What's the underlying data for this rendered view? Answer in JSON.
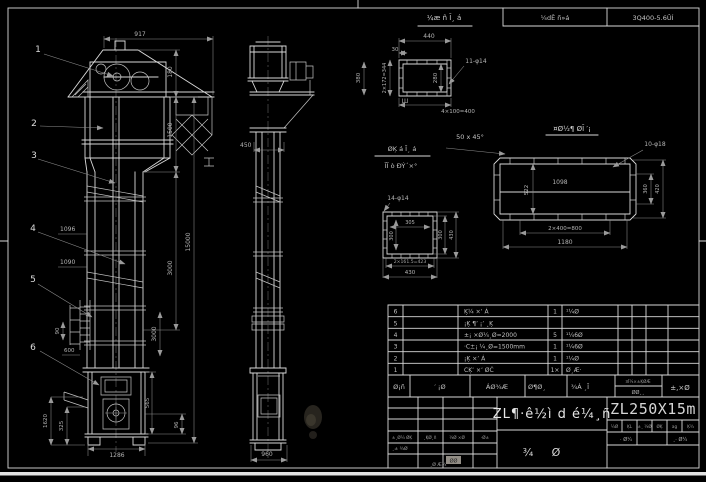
{
  "frame": {
    "top_box_left": "¼dÊ ñ»á",
    "top_box_right": "3Q400-5.6ÛÍ"
  },
  "details": {
    "a": {
      "label": "¼æ ñ Ĩ¸ á",
      "dim_total": "440",
      "dim_edge": "30",
      "dim_left": "2×172=344",
      "dim_inner": "280",
      "dim_bottom": "4×100=400",
      "holes": "11-φ14",
      "mark": "Ш"
    },
    "b": {
      "label": "¤Ø½¶ ØĨ ′¡",
      "chamfer": "50 x 45°",
      "holes": "10-φ18",
      "len_inner": "1098",
      "height": "522",
      "right_inner": "360",
      "right_outer": "420",
      "bottom_inner": "2×400=800",
      "bottom_outer": "1180"
    },
    "c": {
      "label_line1": "ØĶ á Ĩ¸ á",
      "label_line2": "ĨĨ ò ÐÝ´×°",
      "holes": "14-φ14",
      "top_inner": "305",
      "left_inner": "300",
      "right_inner": "300",
      "right_outer": "430",
      "bottom_inner": "2×161.5=423",
      "bottom_outer": "430"
    }
  },
  "front_view": {
    "balloons": [
      "1",
      "2",
      "3",
      "4",
      "5",
      "6"
    ],
    "dims": {
      "width_917": "917",
      "h_180": "180",
      "h_1500": "1500",
      "h_3000": "3000",
      "h_3000b": "3000",
      "h_15000": "15000",
      "s_1096": "1096",
      "s_1090": "1090",
      "ladder_90": "90",
      "ladder_600": "600",
      "boot_1620": "1620",
      "boot_325": "325",
      "boot_1286": "1286",
      "boot_565": "565",
      "boot_96": "96"
    }
  },
  "side_view": {
    "dims": {
      "d_450": "450",
      "d_960": "960",
      "d_380": "380"
    }
  },
  "parts_list": {
    "rows": [
      {
        "no": "6",
        "name": "Ķ¼ ×ʼ Á",
        "qty": "1",
        "material": "¹¼Ø"
      },
      {
        "no": "5",
        "name": "¡Ķ ¶ʼ ¡ʼ ¸Ķ",
        "qty": "",
        "material": ""
      },
      {
        "no": "4",
        "name": "±¡ ×Ø¼¸Ø=2000",
        "qty": "5",
        "material": "¹¼6Ø"
      },
      {
        "no": "3",
        "name": "·C±¡ ¼¸Ø=1500mm",
        "qty": "1",
        "material": "¹¼6Ø"
      },
      {
        "no": "2",
        "name": "¡Ķ ×ʼ Á",
        "qty": "1",
        "material": "¹¼Ø"
      },
      {
        "no": "1",
        "name": "CĶʼ ×ʼ ØĊ",
        "qty": "1×",
        "material": "Ø¸Æ·"
      }
    ]
  },
  "title_block": {
    "header_cells": [
      "Ø¡ñ",
      "′ ¡Ø",
      "ÁØ¾Æ",
      "Ø¶Ø¸",
      "¾Á ¸Ī"
    ],
    "header_small_top": "¤Ī¼×±ĶØÆ",
    "header_small_bottom": "ØØ¸¸",
    "header_last": "±,×Ø",
    "grid_row": [
      "±¸Ø¼ ØĶ",
      "¸ĶØ¸ñ",
      "¼Ø ×Ø",
      "·Ø±"
    ],
    "grid_b": "¸± ¾Ø",
    "grid_gray": "ØØ",
    "grid_below": "¸Ø Æ¼",
    "title_main": "ZL¶·ê½ì d é¼¸ñ",
    "model": "ZL250X15m",
    "right_cells": [
      "¼Ø",
      "ĶL",
      "±¸ ¼Ø",
      "ØĶ",
      "ag",
      "Ķ¾"
    ],
    "right_row2": [
      "· Ø¼",
      "¸· Ø¼"
    ],
    "bottom_left_char": "¾",
    "bottom_right_char": "Ø"
  }
}
